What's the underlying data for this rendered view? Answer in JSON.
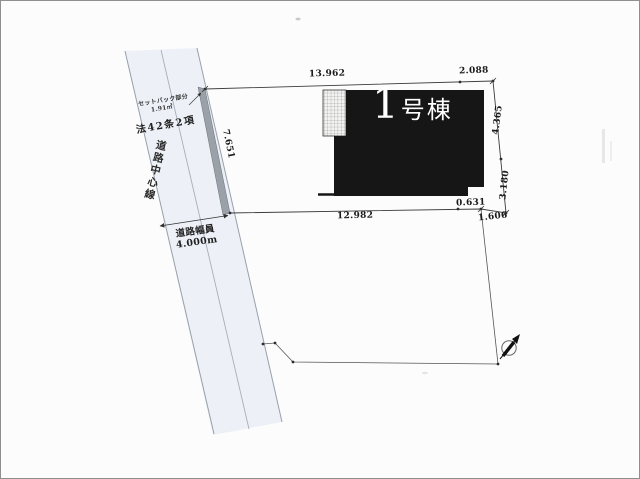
{
  "plan": {
    "building": {
      "number": "1",
      "suffix": "号棟"
    },
    "labels": {
      "law": "法42条2項",
      "road_centerline": "道路中心線",
      "road_width_1": "道路幅員",
      "road_width_2": "4.000m",
      "setback_note_1": "セットバック部分",
      "setback_note_2": "1.91㎡"
    },
    "dimensions": {
      "top_left": "13.962",
      "top_right": "2.088",
      "right_upper": "4.365",
      "right_lower": "3.180",
      "bottom_main": "12.982",
      "bottom_small": "0.631",
      "corner_right": "1.606",
      "frontage": "7.651"
    },
    "colors": {
      "road_fill": "#edf1f7",
      "road_line": "#97a0ac",
      "setback_fill": "#9aa1a9",
      "building_fill": "#161616",
      "boundary_line": "#3c3c3c"
    }
  }
}
